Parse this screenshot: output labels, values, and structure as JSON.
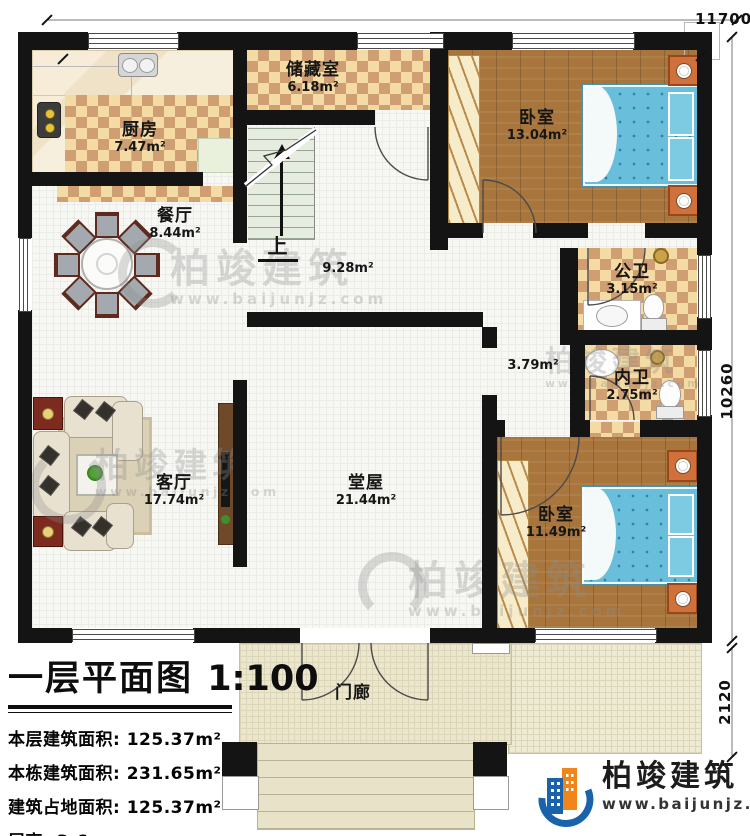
{
  "plan": {
    "title": "一层平面图",
    "scale": "1:100",
    "stats": [
      "本层建筑面积: 125.37m²",
      "本栋建筑面积: 231.65m²",
      "建筑占地面积: 125.37m²",
      "层高: 3.6m"
    ],
    "rooms": {
      "kitchen": {
        "name": "厨房",
        "area": "7.47m²"
      },
      "dining": {
        "name": "餐厅",
        "area": "8.44m²"
      },
      "storage": {
        "name": "储藏室",
        "area": "6.18m²"
      },
      "bedroom1": {
        "name": "卧室",
        "area": "13.04m²"
      },
      "public_bath": {
        "name": "公卫",
        "area": "3.15m²"
      },
      "private_bath": {
        "name": "内卫",
        "area": "2.75m²"
      },
      "bedroom2": {
        "name": "卧室",
        "area": "11.49m²"
      },
      "hall": {
        "name": "堂屋",
        "area": "21.44m²"
      },
      "living": {
        "name": "客厅",
        "area": "17.74m²"
      },
      "porch": {
        "name": "门廊"
      },
      "stairwell": {
        "up_label": "上",
        "area": "9.28m²"
      },
      "corridor": {
        "area": "3.79m²"
      }
    },
    "dimensions": {
      "top": "11700",
      "right": "10260",
      "bottom_right": "2120"
    },
    "brand": {
      "name": "柏竣建筑",
      "website": "www.baijunjz.com",
      "color_blue": "#1a63ac",
      "color_orange": "#f08519"
    },
    "watermark": {
      "name": "柏竣建筑",
      "website": "www.baijunjz.com"
    }
  }
}
